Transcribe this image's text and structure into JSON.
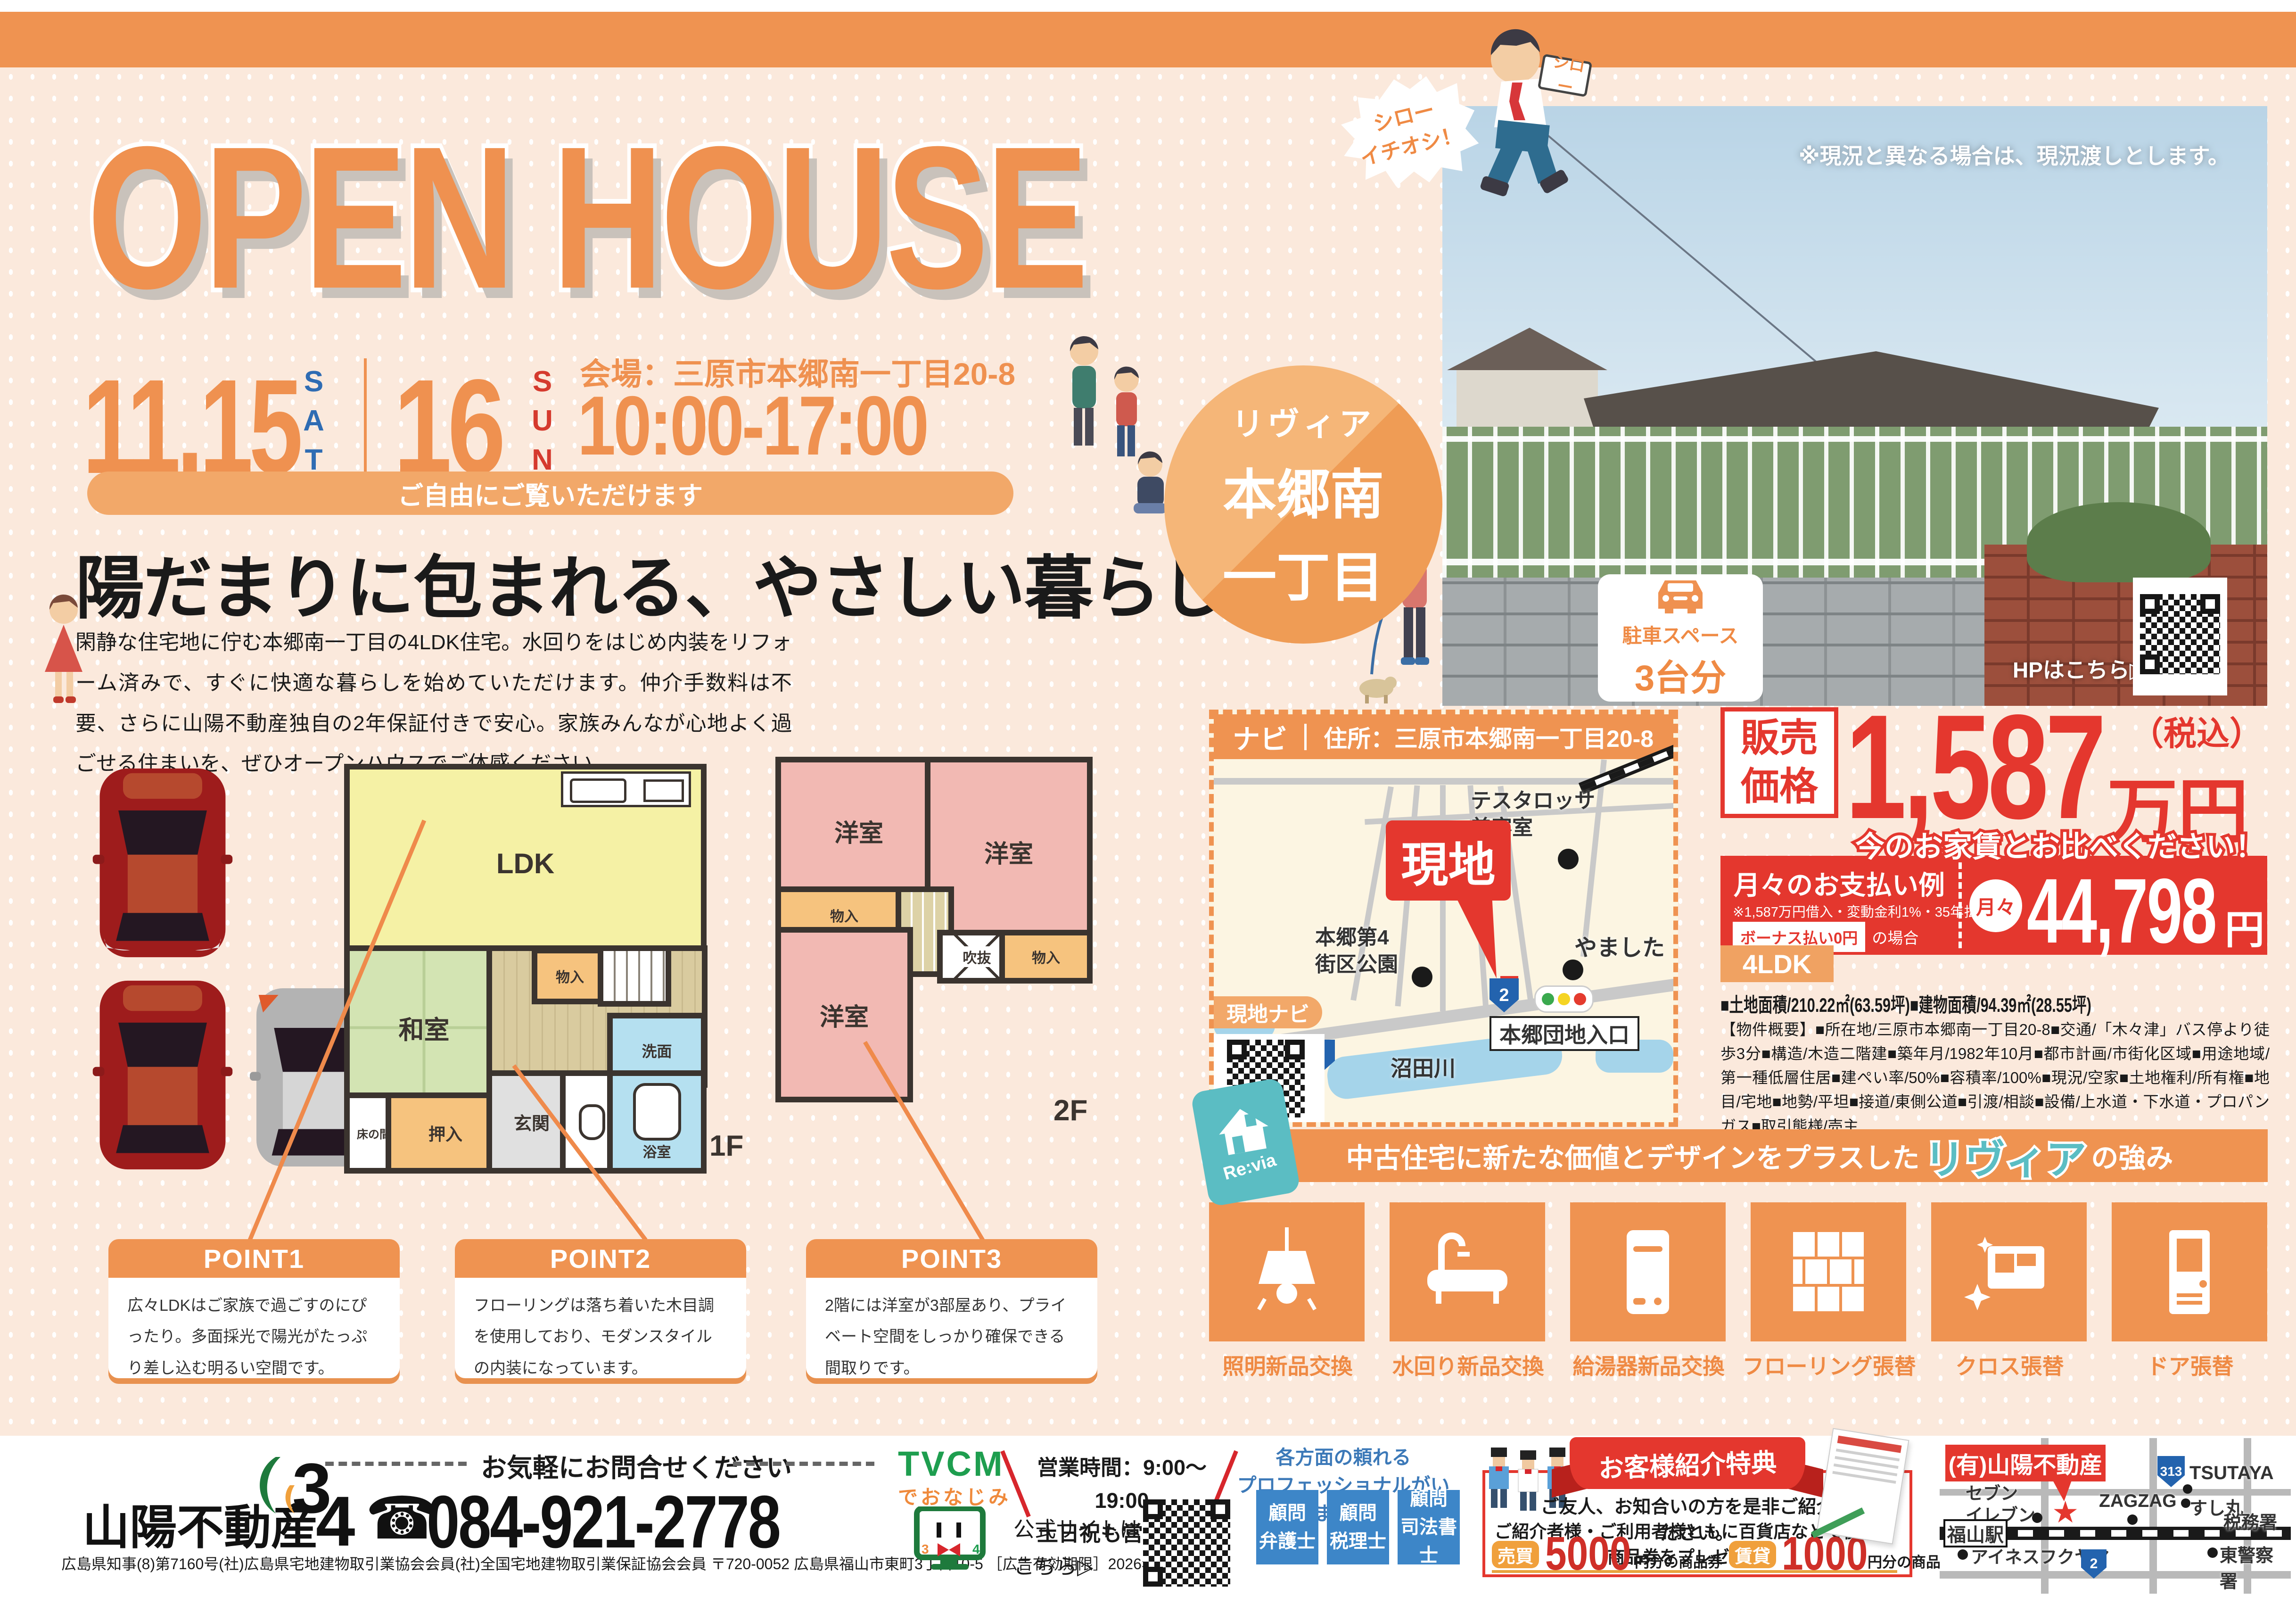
{
  "colors": {
    "accent": "#ef9351",
    "red": "#e4372e",
    "teal": "#5bbdc3",
    "blue": "#3d86c8",
    "price_red": "#e4372e"
  },
  "header": {
    "title": "OPEN HOUSE",
    "date1": "11.15",
    "date1_dow": "SAT",
    "date2": "16",
    "date2_dow": "SUN",
    "venue": "会場：三原市本郷南一丁目20-8",
    "hours": "10:00-17:00",
    "pill": "ご自由にご覧いただけます"
  },
  "mascot": {
    "bubble": "シロー\nイチオシ！",
    "sign": "シロー"
  },
  "location_circle": {
    "line1": "リヴィア",
    "line2": "本郷南",
    "line3": "一丁目"
  },
  "photo": {
    "caption": "※現況と異なる場合は、現況渡しとします。",
    "parking_title": "駐車スペース",
    "parking_count": "3台分",
    "hp": "HPはこちら▷"
  },
  "lead": {
    "headline": "陽だまりに包まれる、やさしい暮らし",
    "body": "閑静な住宅地に佇む本郷南一丁目の4LDK住宅。水回りをはじめ内装をリフォーム済みで、すぐに快適な暮らしを始めていただけます。仲介手数料は不要、さらに山陽不動産独自の2年保証付きで安心。家族みんなが心地よく過ごせる住まいを、ぜひオープンハウスでご体感ください。"
  },
  "floorplan": {
    "f1": "1F",
    "f2": "2F",
    "ldk": "LDK",
    "washitsu": "和室",
    "monoire": "物入",
    "genkan": "玄関",
    "senmen": "洗面",
    "bath": "浴室",
    "tokonoma": "床の間",
    "oshiire": "押入",
    "yoshitsu": "洋室",
    "fukinuke": "吹抜"
  },
  "points": [
    {
      "title": "POINT1",
      "body": "広々LDKはご家族で過ごすのにぴったり。多面採光で陽光がたっぷり差し込む明るい空間です。"
    },
    {
      "title": "POINT2",
      "body": "フローリングは落ち着いた木目調を使用しており、モダンスタイルの内装になっています。"
    },
    {
      "title": "POINT3",
      "body": "2階には洋室が3部屋あり、プライベート空間をしっかり確保できる間取りです。"
    }
  ],
  "map": {
    "navi": "ナビ",
    "address": "住所：三原市本郷南一丁目20-8",
    "genchi": "現地",
    "poi_salon": "テスタロッサ\n美容室",
    "poi_yamashita": "やました",
    "poi_park": "本郷第4\n街区公園",
    "river": "沼田川",
    "poi_entrance": "本郷団地入口",
    "route2": "2",
    "navi_tab": "現地ナビ"
  },
  "price": {
    "label": "販売\n価格",
    "amount": "1,587",
    "unit": "万円",
    "tax": "（税込）",
    "compare": "今のお家賃とお比べください！",
    "monthly_title": "月々のお支払い例",
    "monthly_note": "※1,587万円借入・変動金利1%・35年払い",
    "bonus": "ボーナス払い0円",
    "bonus_suffix": "の場合",
    "monthly_prefix": "月々",
    "monthly_amount": "44,798",
    "monthly_unit": "円"
  },
  "property": {
    "layout": "4LDK",
    "areas": "■土地面積/210.22㎡(63.59坪)■建物面積/94.39㎡(28.55坪)",
    "overview": "【物件概要】■所在地/三原市本郷南一丁目20-8■交通/「木々津」バス停より徒歩3分■構造/木造二階建■築年月/1982年10月■都市計画/市街化区域■用途地域/第一種低層住居■建ぺい率/50%■容積率/100%■現況/空家■土地権利/所有権■地目/宅地■地勢/平坦■接道/東側公道■引渡/相談■設備/上水道・下水道・プロパンガス■取引態様/売主"
  },
  "revia": {
    "brand": "Re:via",
    "heading_pre": "中古住宅に新たな価値とデザインをプラスした",
    "heading_brand": "リヴィア",
    "heading_post": "の強み",
    "items": [
      {
        "label": "照明新品交換",
        "icon": "lamp-icon"
      },
      {
        "label": "水回り新品交換",
        "icon": "bathtub-icon"
      },
      {
        "label": "給湯器新品交換",
        "icon": "water-heater-icon"
      },
      {
        "label": "フローリング張替",
        "icon": "flooring-icon"
      },
      {
        "label": "クロス張替",
        "icon": "wallpaper-icon"
      },
      {
        "label": "ドア張替",
        "icon": "door-icon"
      }
    ]
  },
  "footer": {
    "contact": "お気軽にお問合せください",
    "company": "山陽不動産",
    "logo_num1": "3",
    "logo_num2": "4",
    "phone_icon": "☎",
    "phone": "084-921-2778",
    "license": "広島県知事(8)第7160号(社)広島県宅地建物取引業協会会員(社)全国宅地建物取引業保証協会会員 〒720-0052 広島県福山市東町3丁目10-5 ［広告有効期限］2026年1月末日",
    "tvcm": "TVCM",
    "tvcm_sub": "でおなじみ",
    "hours": "営業時間：9:00～19:00\n土日祝も営業中！",
    "site": "公式サイトは\nこちら▷",
    "pro_heading": "各方面の頼れる\nプロフェッショナルがいます！",
    "advisors": [
      {
        "label": "顧問\n弁護士"
      },
      {
        "label": "顧問\n税理士"
      },
      {
        "label": "顧問\n司法書士"
      }
    ],
    "referral": {
      "ribbon": "お客様紹介特典",
      "line1": "ご友人、お知合いの方を是非ご紹介ください。",
      "line2": "ご紹介者様・ご利用者様ともに百貨店などで使える商品券をプレゼント！",
      "baibai_label": "売買",
      "baibai_amount": "5000",
      "baibai_suffix": "円分の商品券",
      "chintai_label": "賃貸",
      "chintai_amount": "1000",
      "chintai_suffix": "円分の商品券"
    },
    "minimap": {
      "company": "(有)山陽不動産",
      "seven": "セブン\nイレブン",
      "zagzag": "ZAGZAG",
      "tsutaya": "TSUTAYA",
      "sushimaru": "すし丸",
      "zeimusho": "税務署",
      "police": "東警察署",
      "ines": "アイネスフクヤマ",
      "station": "福山駅",
      "r313": "313",
      "r2": "2",
      "star": "★"
    }
  }
}
